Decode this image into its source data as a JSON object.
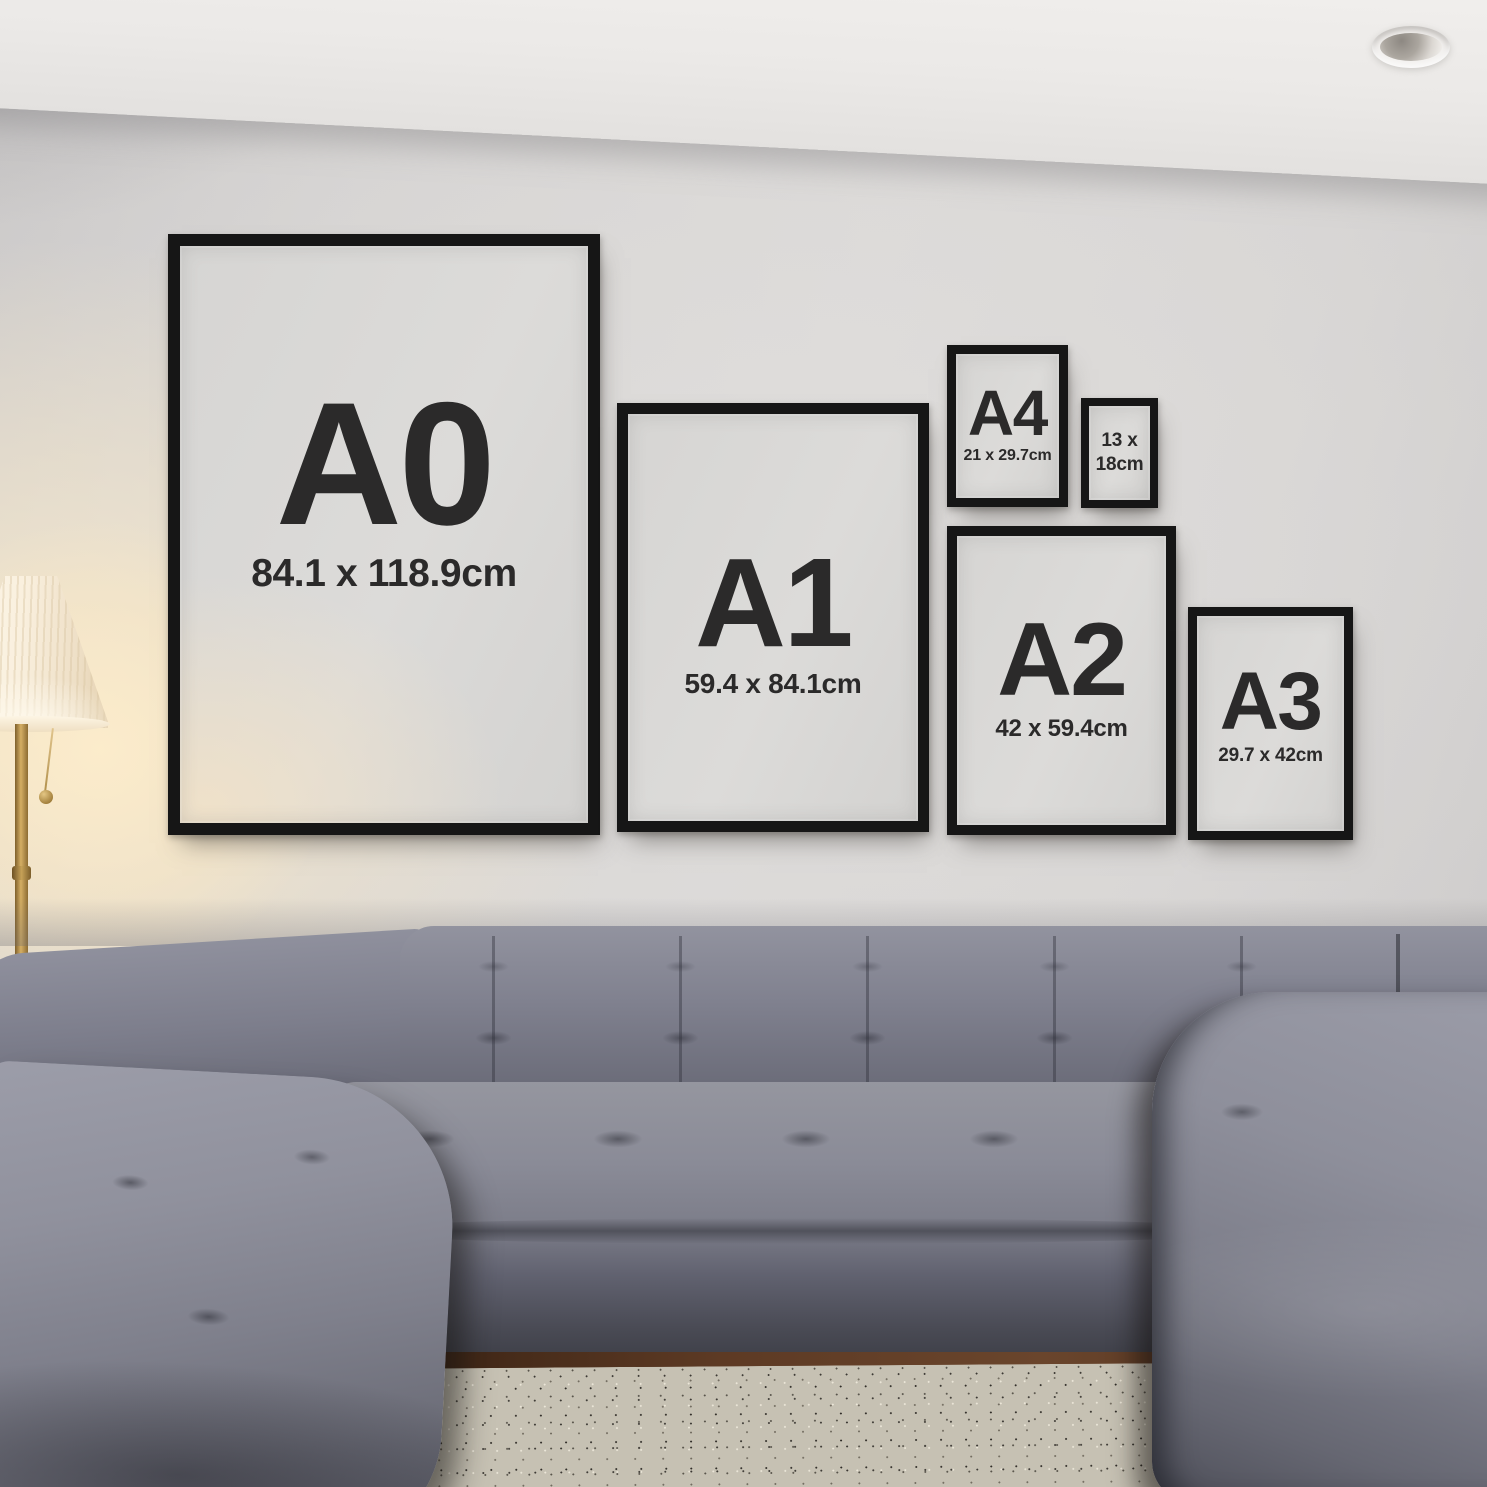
{
  "frames": [
    {
      "name": "A0",
      "label": "A0",
      "size": "84.1 x 118.9cm"
    },
    {
      "name": "A1",
      "label": "A1",
      "size": "59.4 x 84.1cm"
    },
    {
      "name": "A4",
      "label": "A4",
      "size": "21 x 29.7cm"
    },
    {
      "name": "13x18",
      "size": "13 x 18cm"
    },
    {
      "name": "A2",
      "label": "A2",
      "size": "42 x 59.4cm"
    },
    {
      "name": "A3",
      "label": "A3",
      "size": "29.7 x 42cm"
    }
  ],
  "colors": {
    "frame_black": "#161616",
    "poster_background": "#d9d8d6",
    "label_text": "#2b2a2a",
    "wall": "#d3d1d0",
    "ceiling": "#eceae8",
    "lamp_glow": "#f6e8cd",
    "lamp_brass": "#b08a48",
    "sofa_gray": "#787a88",
    "rug_beige": "#c6c1b3",
    "wood_floor": "#5a3a28"
  }
}
